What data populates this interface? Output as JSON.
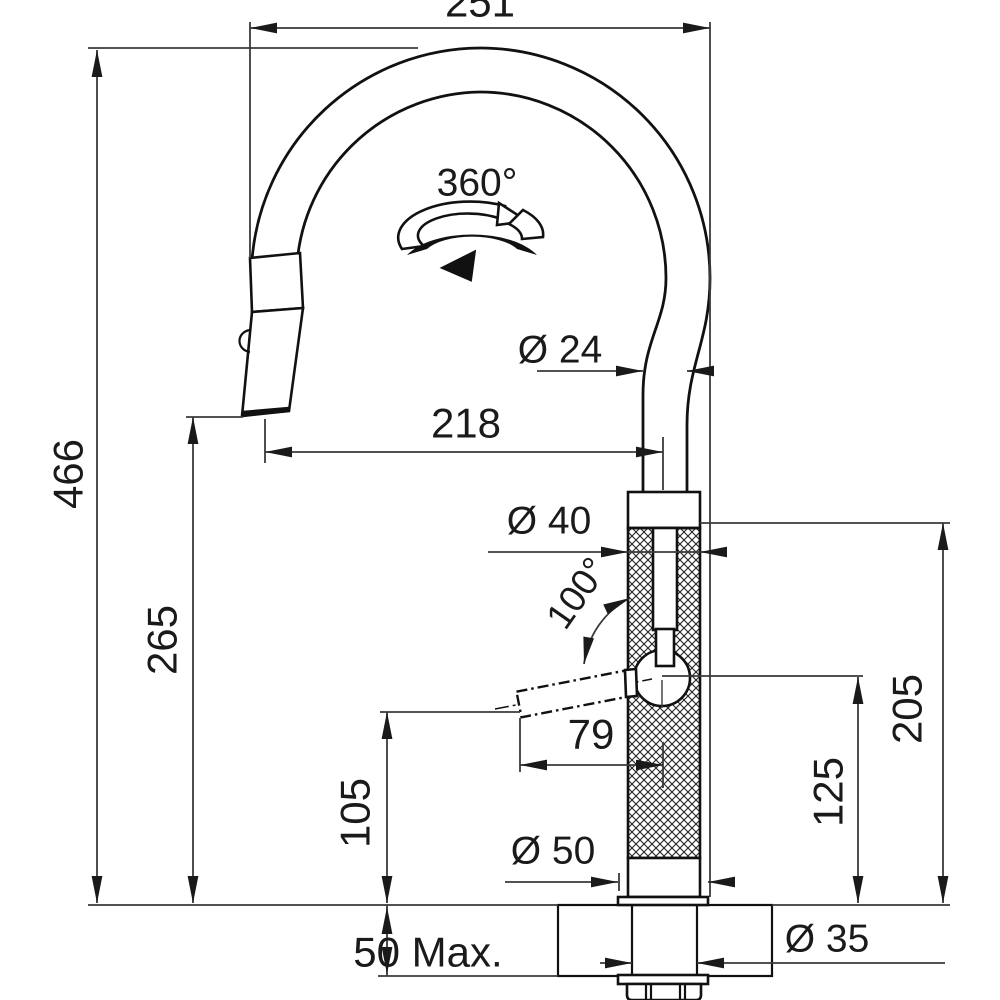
{
  "drawing": {
    "type": "faucet-installation-dimension-drawing",
    "colors": {
      "object_line": "#111111",
      "dimension_line": "#3a3a3a",
      "background": "#ffffff"
    },
    "dimensions": {
      "spout_width_top": "251",
      "total_height": "466",
      "outlet_height": "265",
      "outlet_reach": "218",
      "spout_tube_diameter": "Ø 24",
      "swivel_angle": "360°",
      "body_diameter": "Ø 40",
      "lever_swing_angle": "100°",
      "lever_reach": "79",
      "lever_clearance_height": "105",
      "lever_pivot_height": "125",
      "body_top_height": "205",
      "base_diameter": "Ø 50",
      "max_counter_thickness": "50 Max.",
      "hole_diameter": "Ø 35"
    }
  }
}
